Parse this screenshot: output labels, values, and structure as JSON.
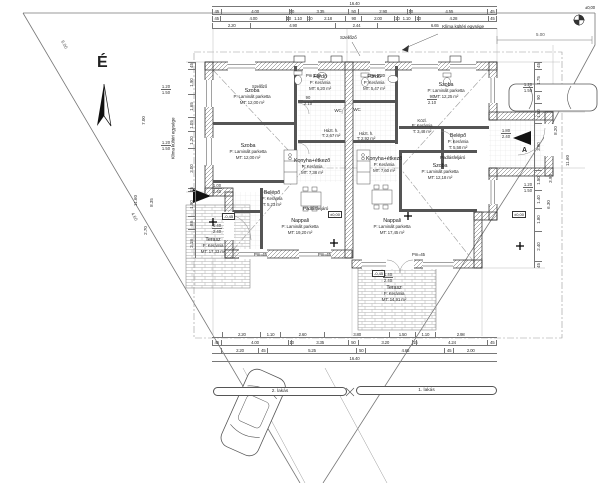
{
  "site": {
    "north": "É",
    "benchmark": "±0,00",
    "left_boundary_dim": "6.00",
    "left_boundary_dim2": "4.60",
    "right_offset": "5.00"
  },
  "units": [
    {
      "name": "2. lakás",
      "rooms": [
        {
          "name": "Szoba",
          "floor": "P: Laminált parketta",
          "area": "MT: 12,00 m²"
        },
        {
          "name": "Szoba",
          "floor": "P: Laminált parketta",
          "area": "MT: 12,00 m²"
        },
        {
          "name": "Fürdő",
          "floor": "P: Kerámia",
          "area": "MT: 6,20 m²"
        },
        {
          "name": "WC",
          "floor": "",
          "area": ""
        },
        {
          "name": "Házt. h.",
          "floor": "",
          "area": "T: 2,67 m²"
        },
        {
          "name": "Konyha+étkező",
          "floor": "P: Kerámia",
          "area": "MT: 7,38 m²"
        },
        {
          "name": "Belépő",
          "floor": "P: Kerámia",
          "area": "T: 5,23 m²"
        },
        {
          "name": "Nappali",
          "floor": "P: Laminált parketta",
          "area": "MT: 19,20 m²"
        },
        {
          "name": "Terasz",
          "floor": "P: Kerámia",
          "area": "MT: 17,33 m²"
        }
      ]
    },
    {
      "name": "1. lakás",
      "rooms": [
        {
          "name": "Fürdő",
          "floor": "P: Kerámia",
          "area": "MT: 5,47 m²"
        },
        {
          "name": "Szoba",
          "floor": "P: Laminált parketta",
          "area": "MT: 12,25 m²"
        },
        {
          "name": "WC",
          "floor": "",
          "area": ""
        },
        {
          "name": "Közl.",
          "floor": "P: Kerámia",
          "area": "T: 3,48 m²"
        },
        {
          "name": "Házt. h.",
          "floor": "",
          "area": "T: 2,92 m²"
        },
        {
          "name": "Belépő",
          "floor": "P: Kerámia",
          "area": "T: 5,58 m²"
        },
        {
          "name": "Konyha+étkező",
          "floor": "P: Kerámia",
          "area": "MT: 7,60 m²"
        },
        {
          "name": "Szoba",
          "floor": "P: Laminált parketta",
          "area": "MT: 12,18 m²"
        },
        {
          "name": "Nappali",
          "floor": "P: Laminált parketta",
          "area": "MT: 17,45 m²"
        },
        {
          "name": "Terasz",
          "floor": "P: Kerámia",
          "area": "MT: 14,91 m²"
        }
      ]
    }
  ],
  "annotations": {
    "szellozo": "Szellőző",
    "klima": "Klíma kültéri egysége",
    "padlas": "Padlásfeljáró",
    "pm_top": "Pm 2,20",
    "pm_bottom": "Pm=45",
    "level_zero": "±0,00",
    "level_minus": "-0,45",
    "section": "A"
  },
  "openings": [
    {
      "w": "1.20",
      "h": "1.50"
    },
    {
      "w": "1.20",
      "h": "1.50"
    },
    {
      "w": "1.20",
      "h": "1.50"
    },
    {
      "w": "1.20",
      "h": "1.50"
    },
    {
      "w": "1.80",
      "h": "2.40"
    },
    {
      "w": "1.00",
      "h": "2.40"
    },
    {
      "w": "1.40",
      "h": "2.40"
    },
    {
      "w": "90",
      "h": "2.10"
    },
    {
      "w": "90",
      "h": "2.10"
    },
    {
      "w": "1.40",
      "h": "2.40"
    }
  ],
  "dims": {
    "top_total": "16.40",
    "top1": [
      "45",
      "4.00",
      "10",
      "3.35",
      "50",
      "2.90",
      "10",
      "4.55",
      "45"
    ],
    "top2": [
      "45",
      "4.00",
      "10",
      "1.10",
      "10",
      "2.18",
      "90",
      "2.00",
      "10",
      "1.10",
      "10",
      "4.28",
      "45"
    ],
    "top3": [
      "2.20",
      "4.90",
      "2.44",
      "6.65"
    ],
    "bot1": [
      "2.20",
      "1.10",
      "2.60",
      "3.80",
      "1.50",
      "1.10",
      "2.98"
    ],
    "bot2": [
      "45",
      "4.00",
      "10",
      "3.35",
      "50",
      "3.20",
      "15",
      "4.24",
      "45"
    ],
    "bot3": [
      "2.20",
      "45",
      "5.25",
      "50",
      "4.65",
      "45",
      "2.00"
    ],
    "bot_total": "16.40",
    "left_col": [
      "45",
      "1.90",
      "1.65",
      "1.05",
      "1.20",
      "3.00",
      "15",
      "1.90",
      "88",
      "2.18"
    ],
    "right_col": [
      "45",
      "1.75",
      "90",
      "1.50",
      "3.80",
      "1.50",
      "1.40",
      "1.80",
      "2.40",
      "45"
    ],
    "left_singles": [
      "7.00",
      "8.35",
      "11.60",
      "2.70"
    ],
    "right_singles": [
      "8.20",
      "3.90",
      "6.30",
      "11.60"
    ]
  }
}
